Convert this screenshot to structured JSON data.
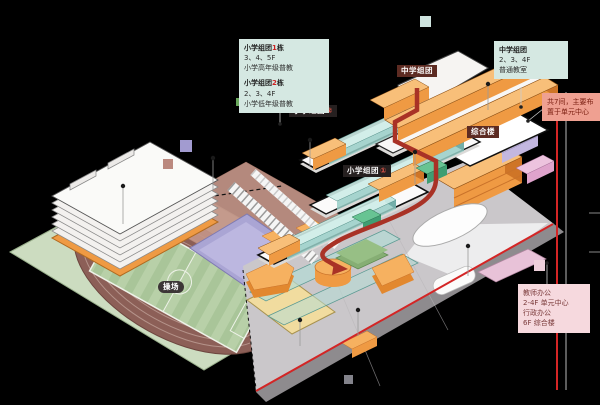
{
  "pills": {
    "middle": {
      "label": "中学组团"
    },
    "primary2": {
      "name": "小学组团",
      "num": "②"
    },
    "complex": {
      "label": "综合楼"
    },
    "primary1": {
      "name": "小学组团",
      "num": "①"
    },
    "playground": {
      "label": "操场"
    }
  },
  "boxes": {
    "top_left": {
      "b1": {
        "pre": "小学组团",
        "num": "1",
        "post": "栋",
        "line2": "3、4、5F",
        "line3": "小学高年级普教"
      },
      "b2": {
        "pre": "小学组团",
        "num": "2",
        "post": "栋",
        "line2": "2、3、4F",
        "line3": "小学低年级普教"
      }
    },
    "top_right": {
      "title": "中学组团",
      "line2": "2、3、4F",
      "line3": "普通教室"
    },
    "right": {
      "line1": "共7间，主要布",
      "line2": "置于单元中心"
    },
    "bottom_right": {
      "line1": "教师办公",
      "line2": "2-4F 单元中心",
      "line3": "行政办公",
      "line4": "6F 综合楼"
    }
  },
  "colors": {
    "background": "#000000",
    "boundary_red": "#d42525",
    "route_red": "#a93226",
    "building_orange": "#ef9a43",
    "glass_teal": "#9cc9c2",
    "block_green": "#3f9e72",
    "track_maroon": "#8c5f57",
    "field_green": "#b8cda6",
    "court_purple": "#aaa5d4",
    "plaza_brown": "#c49588",
    "site_gray": "#cac7ca",
    "info_teal_bg": "#d5e8e2",
    "info_salmon_bg": "#efa091",
    "info_pink_bg": "#f6d9de",
    "pill_maroon_bg": "#5d2b22",
    "pill_black_bg": "#262020",
    "swatches": [
      "#cfe4df",
      "#69a85c",
      "#a29bd0",
      "#bb897f",
      "#eed0db",
      "#83838b"
    ]
  }
}
